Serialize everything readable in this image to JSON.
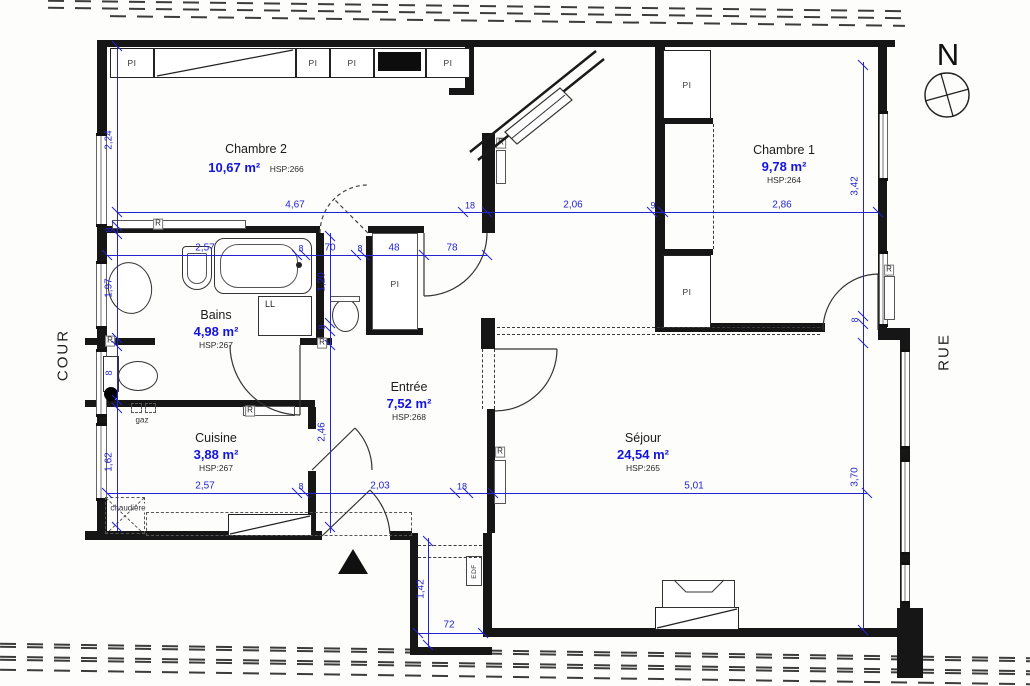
{
  "context": {
    "left_label": "COUR",
    "right_label": "RUE",
    "north": "N"
  },
  "rooms": {
    "chambre2": {
      "name": "Chambre 2",
      "area": "10,67 m²",
      "hsp": "HSP:266"
    },
    "chambre1": {
      "name": "Chambre 1",
      "area": "9,78 m²",
      "hsp": "HSP:264"
    },
    "bains": {
      "name": "Bains",
      "area": "4,98 m²",
      "hsp": "HSP:267"
    },
    "entree": {
      "name": "Entrée",
      "area": "7,52 m²",
      "hsp": "HSP:268"
    },
    "cuisine": {
      "name": "Cuisine",
      "area": "3,88 m²",
      "hsp": "HSP:267"
    },
    "sejour": {
      "name": "Séjour",
      "area": "24,54 m²",
      "hsp": "HSP:265"
    }
  },
  "equipment": {
    "closet": "PI",
    "radiator": "R",
    "washer": "LL",
    "gas": "gaz",
    "boiler": "chaudière",
    "meter": "EDF"
  },
  "dims": {
    "h_top": {
      "d1": "4,67",
      "d2": "18",
      "d3": "2,06",
      "d4": "9",
      "d5": "2,86"
    },
    "h_mid": {
      "d1": "2,57",
      "d2": "8",
      "d3": "70",
      "d4": "8",
      "d5": "48",
      "d6": "78"
    },
    "h_bot": {
      "d1": "2,57",
      "d2": "8",
      "d3": "2,03",
      "d4": "18",
      "d5": "5,01"
    },
    "v_left": {
      "d1": "2,24",
      "d2": "8",
      "d3": "1,97",
      "d4": "8",
      "d5": "1,62"
    },
    "v_mid": {
      "d1": "1,20",
      "d2": "8",
      "d3": "2,46"
    },
    "v_right": {
      "d1": "3,42",
      "d2": "8",
      "d3": "3,70"
    },
    "corridor": {
      "depth": "1,42",
      "width": "72"
    }
  },
  "colors": {
    "dimension_blue": "#2323cf",
    "area_blue": "#1313dd",
    "wall_black": "#161616"
  }
}
